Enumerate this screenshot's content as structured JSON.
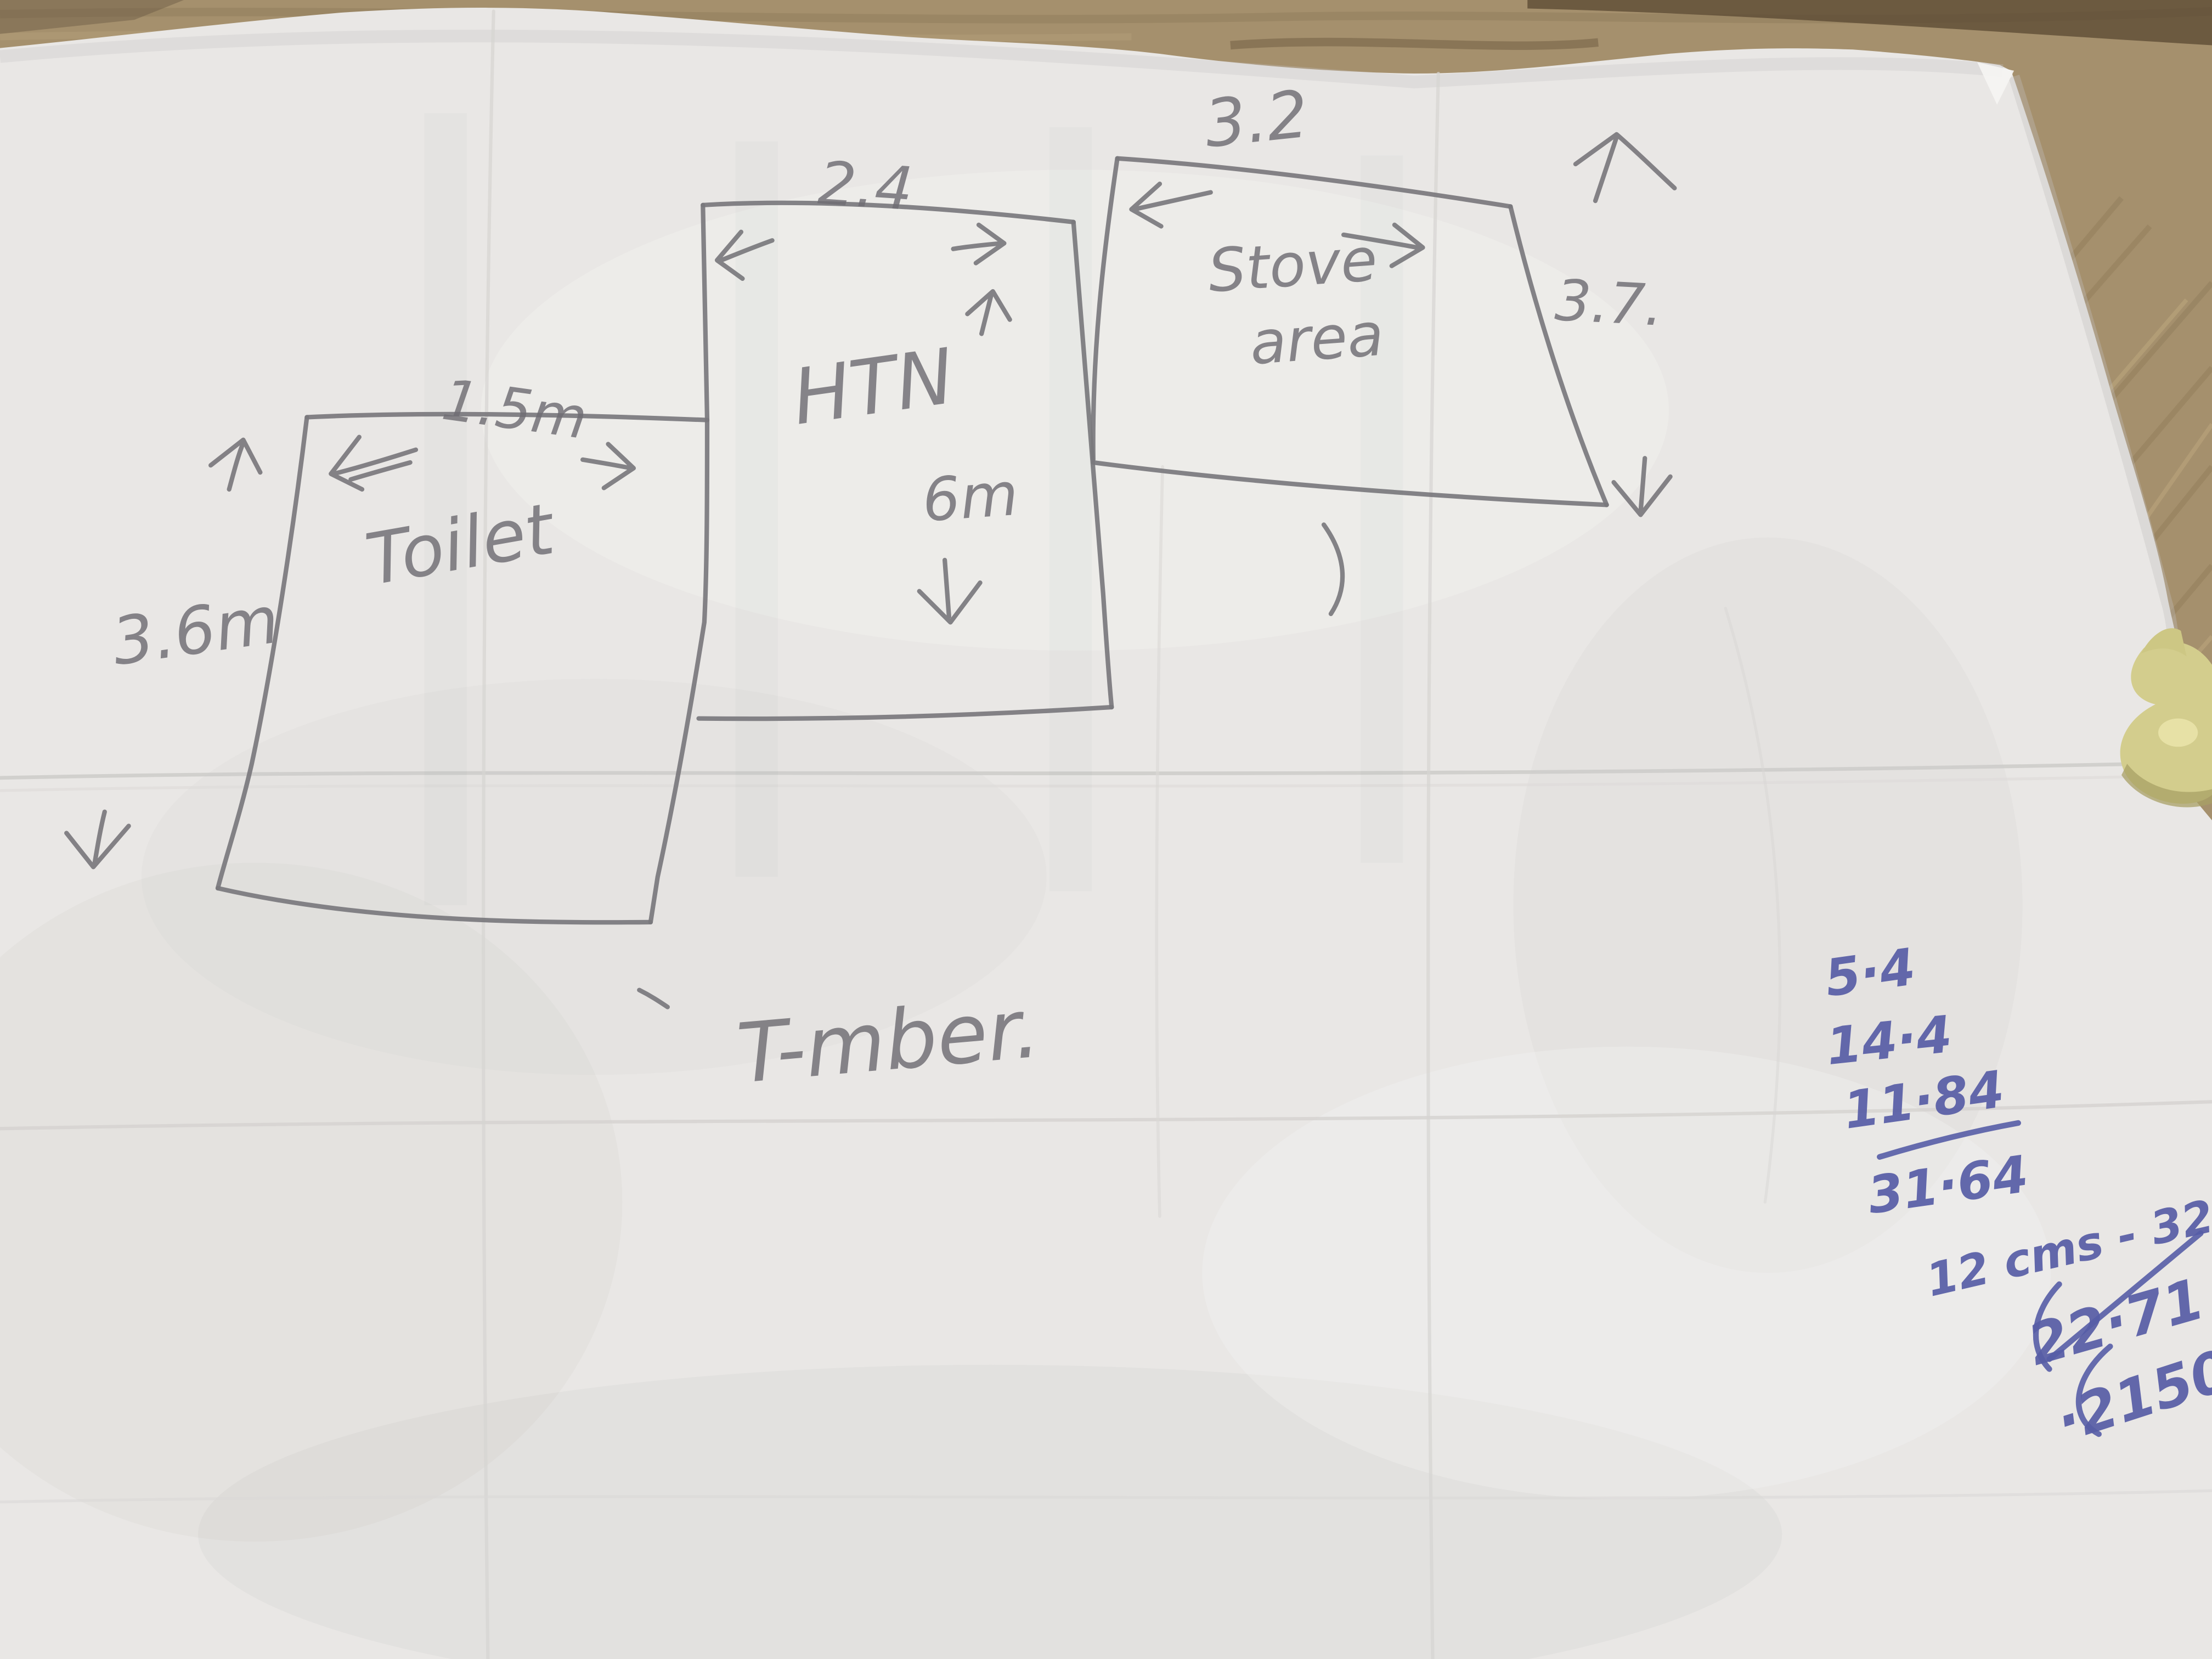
{
  "sketch": {
    "toilet": {
      "label": "Toilet",
      "width_dim": "1.5m",
      "height_dim": "3.6m"
    },
    "htn": {
      "label": "HTN",
      "width_dim": "2.4",
      "height_dim": "6m"
    },
    "stove": {
      "label_line1": "Stove",
      "label_line2": "area",
      "width_dim": "3.2",
      "height_dim": "3.7."
    },
    "material_note": "T-mber."
  },
  "calculations": {
    "addends": [
      "5·4",
      "14·4",
      "11·84"
    ],
    "total": "31·64",
    "scale_note": "12 cms - 32·",
    "crossed_out": "22·71",
    "result": "·2150"
  },
  "colors": {
    "pencil": "#7a787d",
    "ink_blue": "#575da6",
    "paper": "#e9e7e5",
    "wood": "#a5906d",
    "putty_yellow": "#d3cd8d"
  }
}
